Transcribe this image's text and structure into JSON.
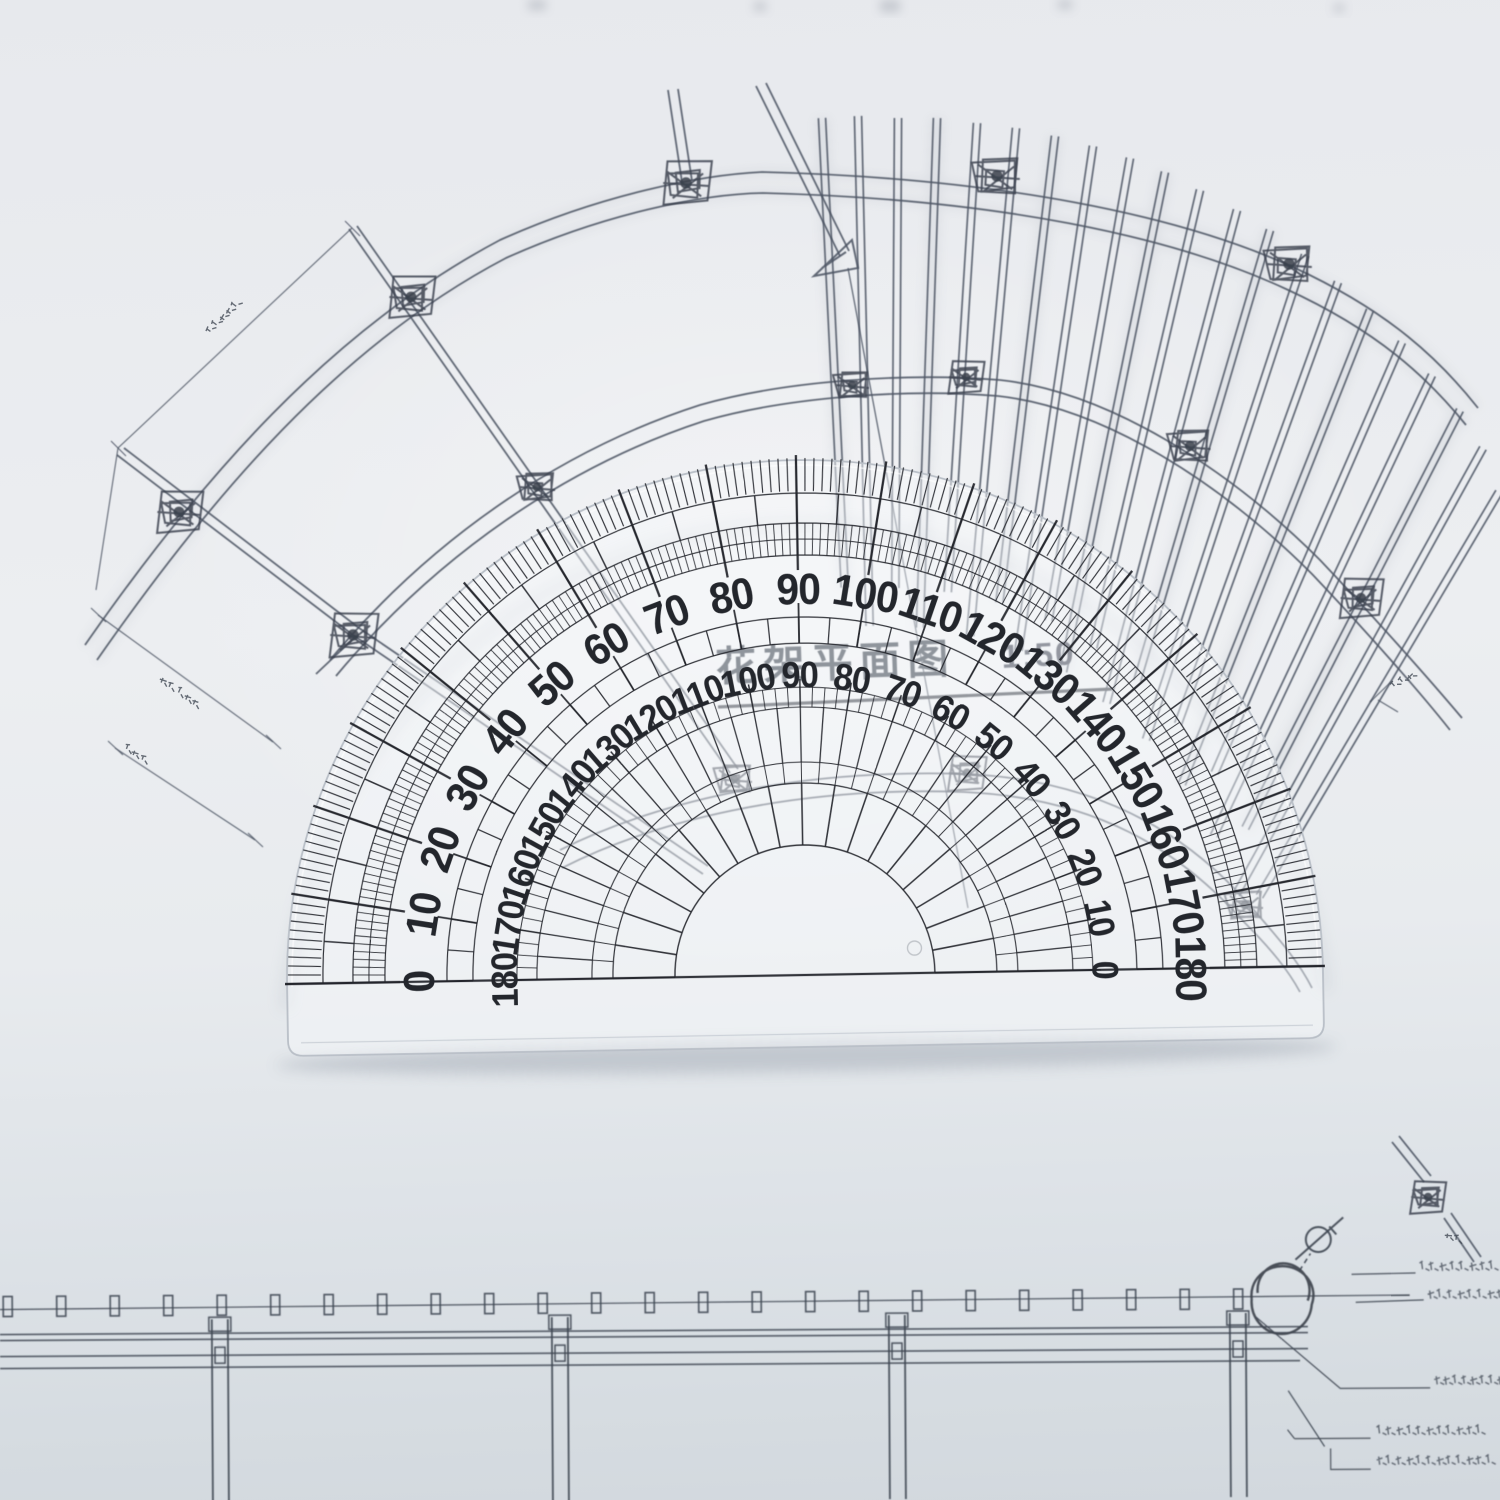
{
  "scene": {
    "type": "photograph",
    "subject": "Transparent semicircular protractor lying on an architectural pergola blueprint",
    "paper_color": "#e9ebee",
    "ink_color": "#4d5564",
    "protractor_ink_color": "#23262c",
    "plastic_edge_color": "#bcc2ca"
  },
  "protractor": {
    "shape": "semicircular 180-degree",
    "outer_scale": {
      "direction": "left-to-right",
      "step_degrees": 10,
      "labels": [
        "0",
        "10",
        "20",
        "30",
        "40",
        "50",
        "60",
        "70",
        "80",
        "90",
        "100",
        "110",
        "120",
        "130",
        "140",
        "150",
        "160",
        "170",
        "180"
      ]
    },
    "inner_scale": {
      "direction": "right-to-left",
      "step_degrees": 10,
      "labels": [
        "180",
        "170",
        "160",
        "150",
        "140",
        "130",
        "120",
        "110",
        "100",
        "90",
        "80",
        "70",
        "60",
        "50",
        "40",
        "30",
        "20",
        "10",
        "0"
      ]
    },
    "fine_tick_degrees": 1,
    "medium_tick_degrees": 5,
    "major_tick_degrees": 10
  },
  "drawing": {
    "title": "花架平面图",
    "scale_ratio": "1:50",
    "plan": {
      "description": "fan-shaped pergola plan with radiating rafters, curved beams and column nodes",
      "node_count": 14,
      "rafter_count": 21,
      "dimension_text_legible": false
    },
    "elevation": {
      "description": "pergola elevation strip at bottom with columns and rafter ends",
      "column_count": 4,
      "rafter_end_count": 24,
      "right_annotation_rows": 5,
      "annotation_text_legible": false
    }
  }
}
